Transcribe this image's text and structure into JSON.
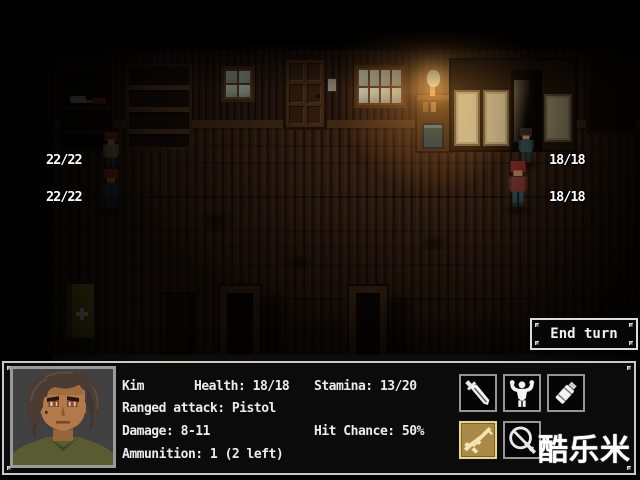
{
  "game": {
    "end_turn_label": "End turn",
    "units": [
      {
        "id": "ally-1",
        "hp": "22/22"
      },
      {
        "id": "ally-2",
        "hp": "22/22"
      },
      {
        "id": "enemy-1",
        "hp": "18/18"
      },
      {
        "id": "enemy-2",
        "hp": "18/18"
      }
    ]
  },
  "character_panel": {
    "name": "Kim",
    "health": "Health: 18/18",
    "stamina": "Stamina: 13/20",
    "ranged_attack": "Ranged attack: Pistol",
    "damage": "Damage: 8-11",
    "hit_chance": "Hit Chance: 50%",
    "ammunition": "Ammunition: 1 (2 left)"
  },
  "actions": [
    {
      "name": "knife",
      "selected": false
    },
    {
      "name": "melee",
      "selected": false
    },
    {
      "name": "throwable",
      "selected": false
    },
    {
      "name": "rifle",
      "selected": true
    },
    {
      "name": "no-attack",
      "selected": false
    }
  ],
  "watermark": "酷乐米",
  "colors": {
    "selected_action_bg": "#a98a46",
    "selected_action_border": "#ecd489",
    "panel_border": "#c9c9c9",
    "hud_text": "#ffffff",
    "lamp_glow": "#ffba5c"
  }
}
